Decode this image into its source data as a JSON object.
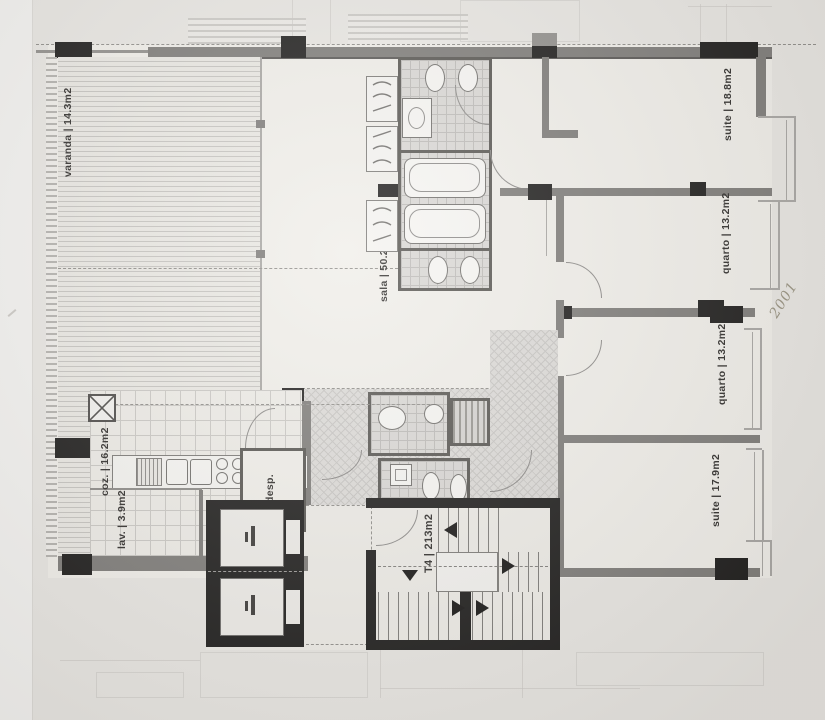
{
  "floorplan": {
    "unit_label": "T4 | 213m2",
    "handwritten_note": "2001",
    "rooms": [
      {
        "id": "varanda",
        "label": "varanda | 14.3m2"
      },
      {
        "id": "sala",
        "label": "sala | 50.2m2"
      },
      {
        "id": "suite-top",
        "label": "suite | 18.8m2"
      },
      {
        "id": "quarto-1",
        "label": "quarto | 13.2m2"
      },
      {
        "id": "quarto-2",
        "label": "quarto | 13.2m2"
      },
      {
        "id": "suite-bottom",
        "label": "suite | 17.9m2"
      },
      {
        "id": "cozinha",
        "label": "coz. | 16.2m2"
      },
      {
        "id": "lavandaria",
        "label": "lav. | 3.9m2"
      },
      {
        "id": "despensa",
        "label": "desp."
      }
    ],
    "colors": {
      "paper": "#e8e6e2",
      "room_fill": "#f0eee9",
      "wall_gray": "#7c7a77",
      "wall_black": "#1b1a19",
      "label_ink": "#2d2b29",
      "pencil": "#97917f"
    }
  }
}
